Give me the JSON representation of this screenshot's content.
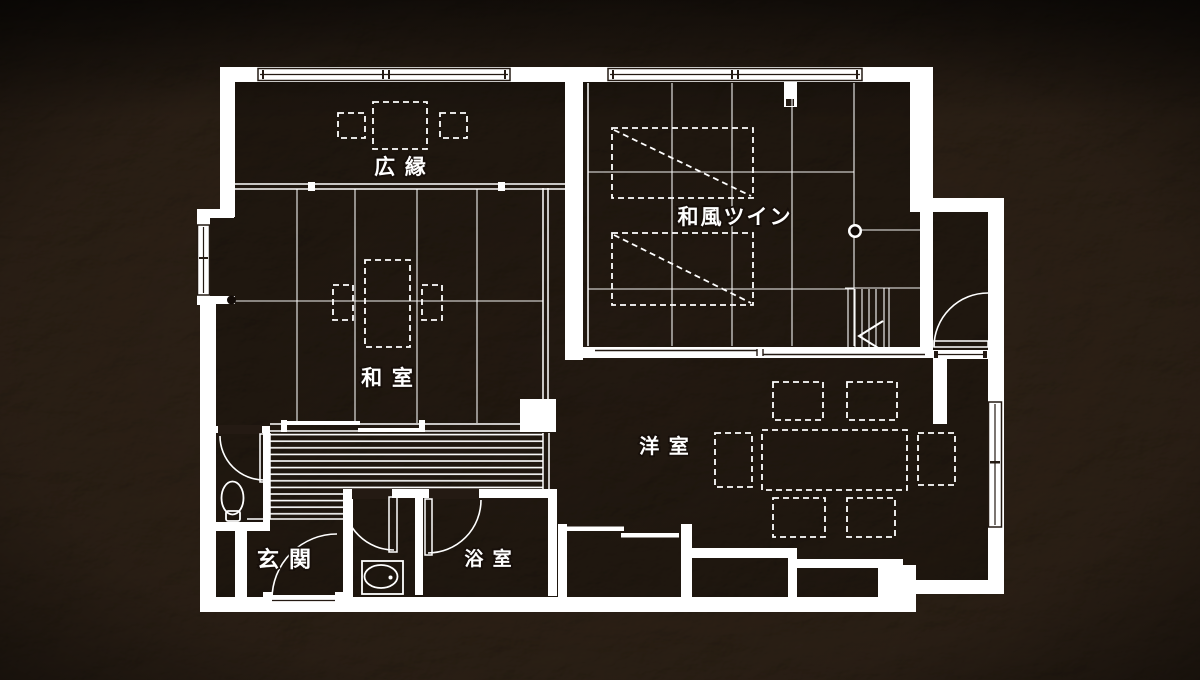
{
  "title": "ryokan-guest-room-floor-plan",
  "colors": {
    "background": "#1b120c",
    "texture_highlight": "#53402f",
    "wall": "#ffffff",
    "line": "#ffffff",
    "dark_line": "#241a13"
  },
  "rooms": {
    "hiroen": {
      "label": "広 縁"
    },
    "wafu_twin": {
      "label": "和風ツイン"
    },
    "washitsu": {
      "label": "和 室"
    },
    "youshitsu": {
      "label": "洋 室"
    },
    "genkan": {
      "label": "玄 関"
    },
    "yokushitsu": {
      "label": "浴 室"
    }
  }
}
